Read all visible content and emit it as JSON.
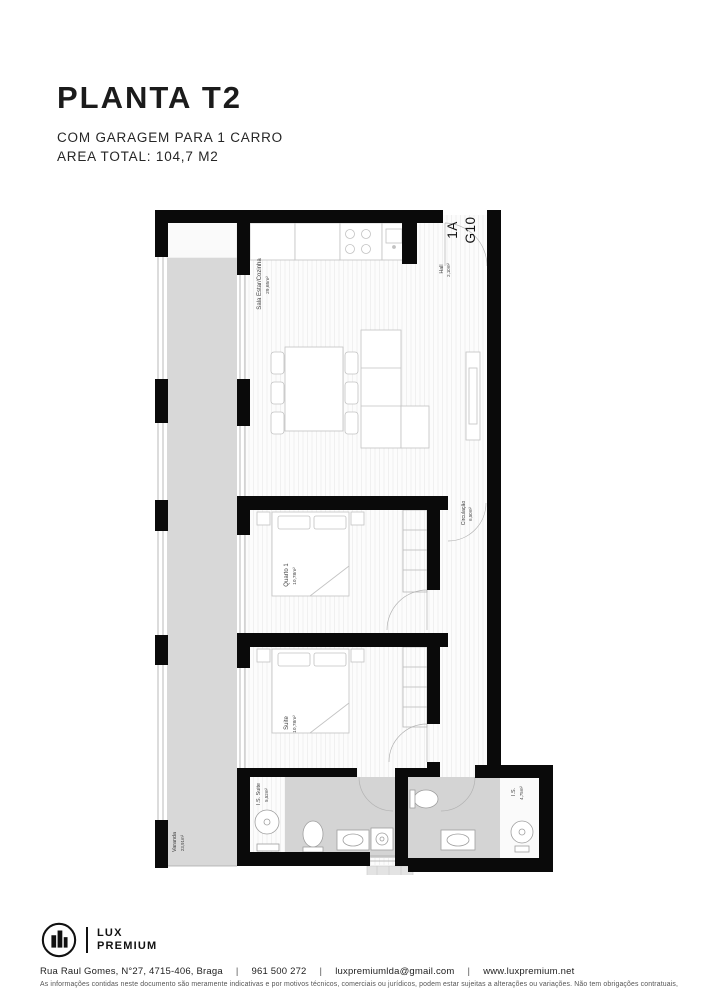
{
  "header": {
    "title": "PLANTA T2",
    "subtitle": "COM GARAGEM PARA 1 CARRO",
    "area_total": "AREA TOTAL: 104,7 M2"
  },
  "plan": {
    "unit": {
      "line1": "1A",
      "line2": "G10"
    },
    "rooms": [
      {
        "name": "Sala Estar/Cozinha",
        "area": "29,65m²"
      },
      {
        "name": "Hall",
        "area": "2,10m²"
      },
      {
        "name": "Circulação",
        "area": "6,50m²"
      },
      {
        "name": "Quarto 1",
        "area": "10,78m²"
      },
      {
        "name": "Suite",
        "area": "10,78m²"
      },
      {
        "name": "I.S. Suite",
        "area": "5,52m²"
      },
      {
        "name": "I.S.",
        "area": "4,75m²"
      },
      {
        "name": "Varanda",
        "area": "23,91m²"
      }
    ]
  },
  "footer": {
    "logo": {
      "icon": "building-in-circle-icon",
      "line1": "LUX",
      "line2": "PREMIUM"
    },
    "address": "Rua Raul Gomes, N°27, 4715-406, Braga",
    "phone": "961 500 272",
    "email": "luxpremiumlda@gmail.com",
    "website": "www.luxpremium.net",
    "separator": "|",
    "disclaimer": "As informações contidas neste documento são meramente indicativas e por motivos técnicos, comerciais ou jurídicos, podem estar sujeitas a alterações ou variações. Não tem obrigações contratuais,"
  },
  "colors": {
    "wall": "#0a0a0a",
    "floor_gray": "#d7d7d7",
    "text": "#1c1c1c"
  }
}
